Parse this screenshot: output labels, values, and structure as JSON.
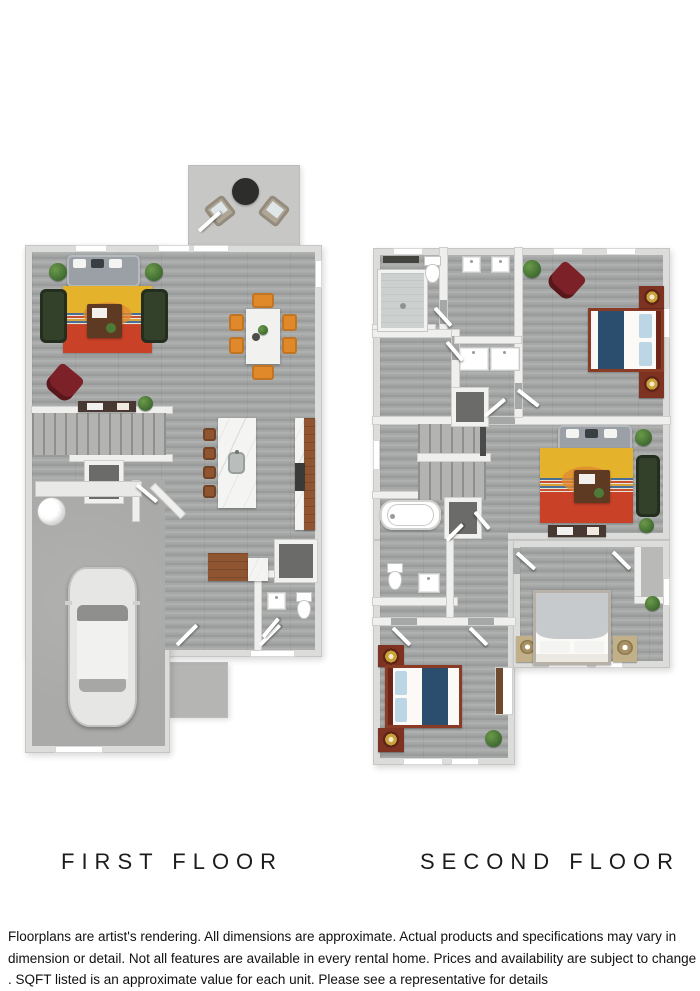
{
  "page": {
    "background": "#ffffff",
    "width": 700,
    "height": 990
  },
  "labels": {
    "first_floor": "FIRST FLOOR",
    "second_floor": "SECOND FLOOR"
  },
  "disclaimer": {
    "lines": [
      "Floorplans are artist's rendering. All dimensions are approximate. Actual products and specifications may vary in",
      "dimension or detail. Not all features are available in every rental home. Prices and availability are subject to change",
      ". SQFT listed is an approximate value for each unit. Please see a representative for details"
    ]
  },
  "palette": {
    "wall": "#dcdcda",
    "floor": "#a6a8a7",
    "concrete": "#aaaaa8",
    "patio": "#c7c7c5",
    "rug-yellow": "#e5b22c",
    "rug-red": "#c94127",
    "rug-orange": "#df8a30",
    "sofa-gray": "#9aa0a5",
    "olive": "#33402a",
    "accent-red": "#7c2127",
    "dining-orange": "#e0892b",
    "wood-brown": "#8f5430",
    "marble": "#f4f4f2",
    "navy": "#2c4e6e",
    "bed-frame": "#8a3b26",
    "pillow-blue": "#bcd6e6",
    "nightstand": "#7e3322",
    "lamp-gold": "#c9a23c",
    "plant-green": "#4e7a38",
    "appliance-dark": "#3a3a38",
    "text-dark": "#1c1c1c"
  },
  "floorplans": {
    "first": {
      "label": "FIRST FLOOR",
      "areas": [
        "patio",
        "living-room",
        "dining-area",
        "kitchen",
        "stairs",
        "garage",
        "powder-room",
        "pantry",
        "entry",
        "front-porch"
      ]
    },
    "second": {
      "label": "SECOND FLOOR",
      "areas": [
        "master-bathroom",
        "walk-in-closet",
        "laundry",
        "master-bedroom",
        "stairs",
        "loft",
        "bathroom",
        "hallway",
        "bedroom-2",
        "bedroom-3",
        "closet"
      ]
    }
  }
}
